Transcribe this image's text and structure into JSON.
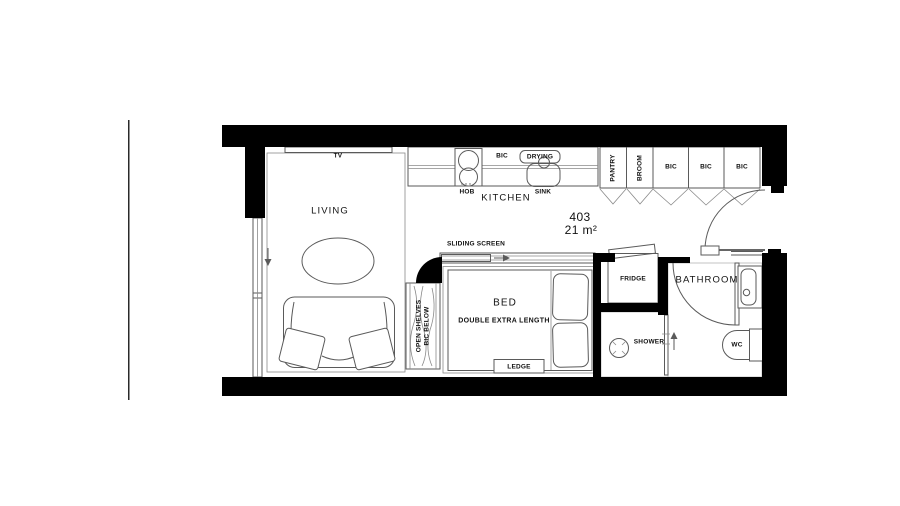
{
  "unit": {
    "number": "403",
    "area": "21 m²"
  },
  "labels": {
    "tv": "TV",
    "living": "LIVING",
    "hob": "HOB",
    "bic_counter": "BIC",
    "drying": "DRYING",
    "sink": "SINK",
    "kitchen": "KITCHEN",
    "pantry": "PANTRY",
    "broom": "BROOM",
    "bic_1": "BIC",
    "bic_2": "BIC",
    "bic_3": "BIC",
    "sliding_screen": "SLIDING SCREEN",
    "open_shelves_line1": "OPEN SHELVES",
    "open_shelves_line2": "BIC BELOW",
    "bed": "BED",
    "bed_subtitle": "DOUBLE EXTRA LENGTH",
    "ledge": "LEDGE",
    "fridge": "FRIDGE",
    "bathroom": "BATHROOM",
    "shower": "SHOWER",
    "wc": "WC"
  },
  "colors": {
    "wall": "#000000",
    "furniture_line": "#5a5a5a",
    "light_line": "#8a8a8a",
    "tile_line": "#c6c6c6",
    "text": "#111111",
    "background": "#ffffff"
  }
}
